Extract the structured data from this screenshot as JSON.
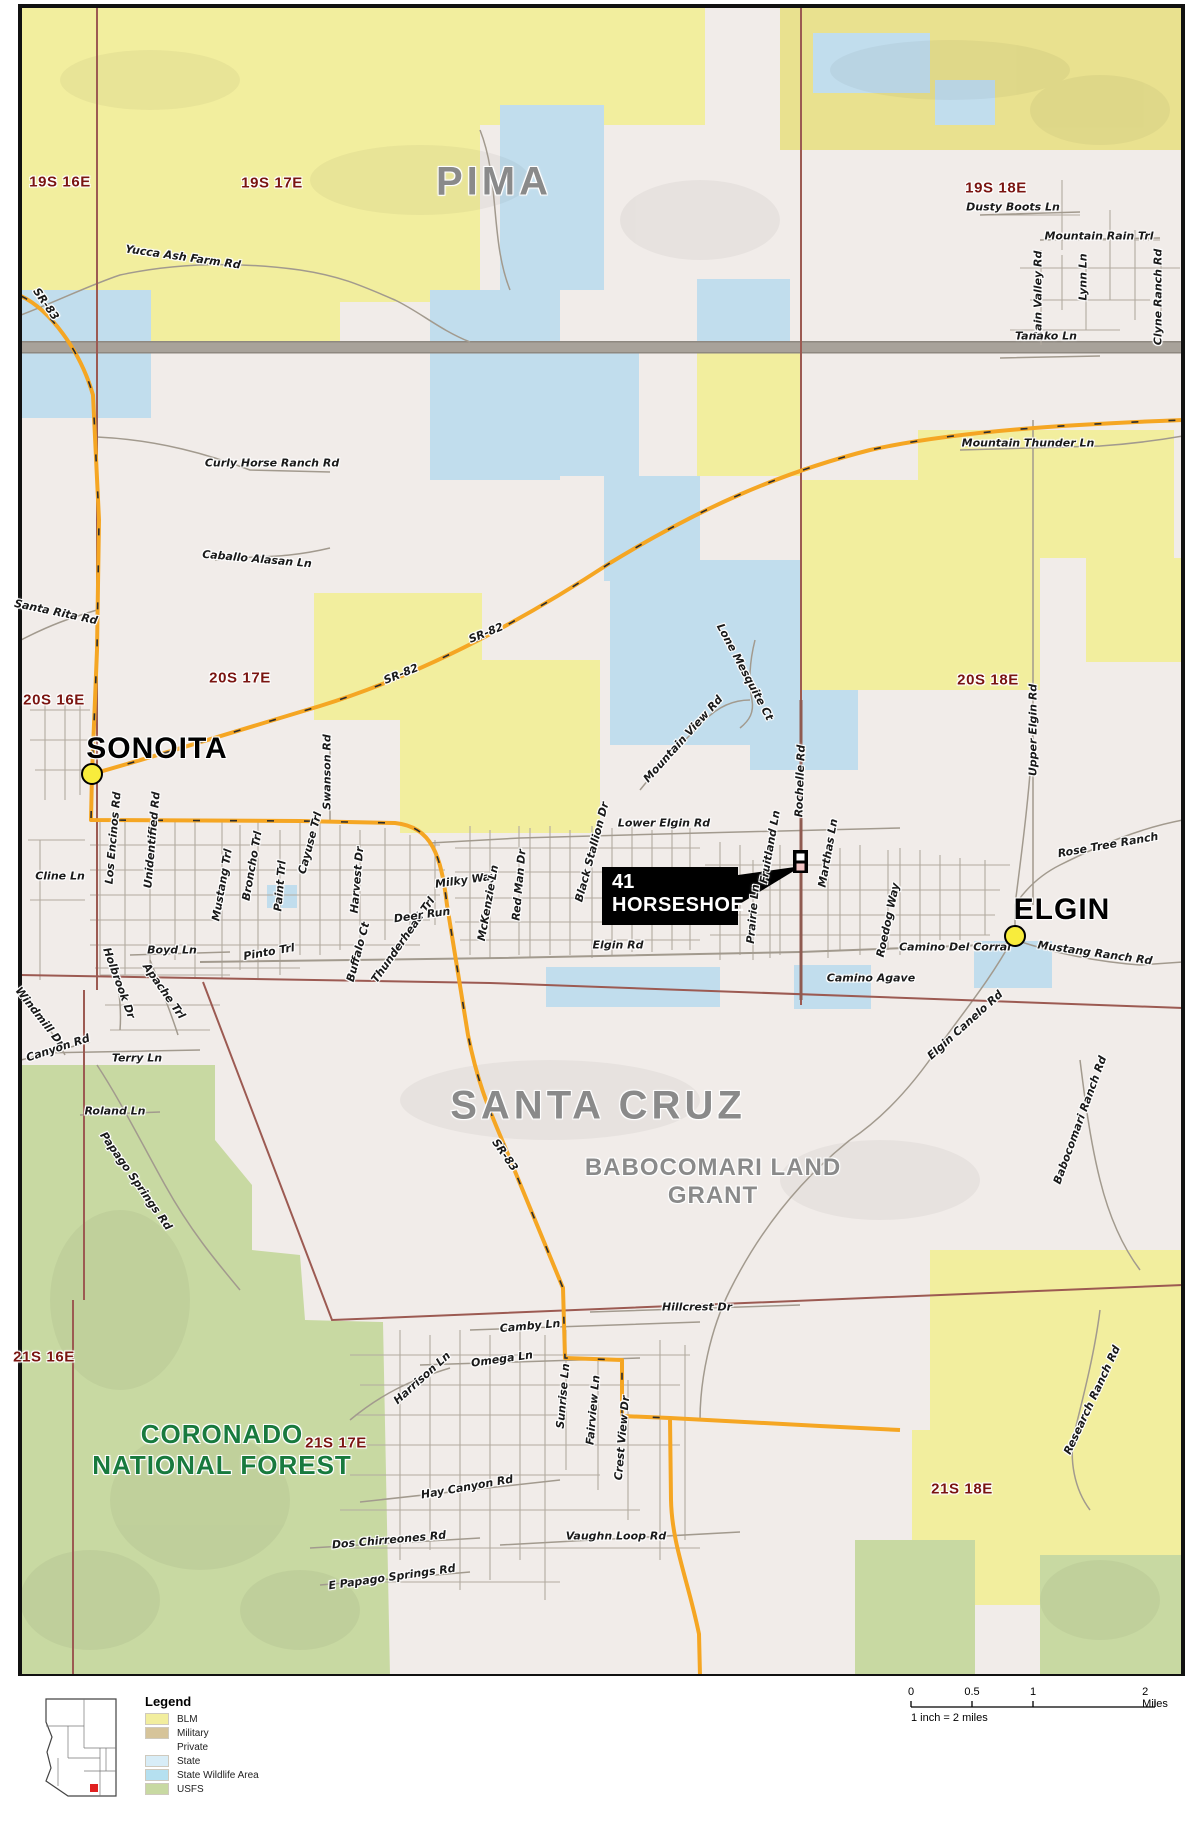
{
  "map": {
    "counties": [
      {
        "t": "PIMA",
        "x": 494,
        "y": 182
      },
      {
        "t": "SANTA CRUZ",
        "x": 598,
        "y": 1106
      }
    ],
    "towns": [
      {
        "t": "SONOITA",
        "x": 157,
        "y": 749,
        "dx": 92,
        "dy": 774
      },
      {
        "t": "ELGIN",
        "x": 1062,
        "y": 910,
        "dx": 1015,
        "dy": 936
      }
    ],
    "townships": [
      {
        "t": "19S 16E",
        "x": 60,
        "y": 182
      },
      {
        "t": "19S 17E",
        "x": 272,
        "y": 183
      },
      {
        "t": "19S 18E",
        "x": 996,
        "y": 188
      },
      {
        "t": "20S 16E",
        "x": 54,
        "y": 700
      },
      {
        "t": "20S 17E",
        "x": 240,
        "y": 678
      },
      {
        "t": "20S 18E",
        "x": 988,
        "y": 680
      },
      {
        "t": "21S 16E",
        "x": 44,
        "y": 1357
      },
      {
        "t": "21S 17E",
        "x": 336,
        "y": 1443
      },
      {
        "t": "21S 18E",
        "x": 962,
        "y": 1489
      }
    ],
    "areas": [
      {
        "cls": "area-green",
        "lines": [
          "CORONADO",
          "NATIONAL FOREST"
        ],
        "x": 222,
        "y": 1450
      },
      {
        "cls": "area-gray",
        "lines": [
          "BABOCOMARI LAND",
          "GRANT"
        ],
        "x": 713,
        "y": 1182
      }
    ],
    "callout": {
      "line1": "41",
      "line2": "HORSESHOE"
    },
    "roads": [
      {
        "t": "Yucca Ash Farm Rd",
        "x": 183,
        "y": 257,
        "r": 8
      },
      {
        "t": "SR-83",
        "x": 46,
        "y": 304,
        "r": 55
      },
      {
        "t": "Dusty Boots Ln",
        "x": 1013,
        "y": 207,
        "r": 0
      },
      {
        "t": "Mountain Rain Trl",
        "x": 1099,
        "y": 236,
        "r": 0
      },
      {
        "t": "Rain Valley Rd",
        "x": 1038,
        "y": 295,
        "r": -90
      },
      {
        "t": "Lynn Ln",
        "x": 1083,
        "y": 277,
        "r": -90
      },
      {
        "t": "Clyne Ranch Rd",
        "x": 1158,
        "y": 297,
        "r": -90
      },
      {
        "t": "Tanako Ln",
        "x": 1046,
        "y": 336,
        "r": 0
      },
      {
        "t": "Mountain Thunder Ln",
        "x": 1028,
        "y": 443,
        "r": 0
      },
      {
        "t": "Curly Horse Ranch Rd",
        "x": 272,
        "y": 463,
        "r": 0
      },
      {
        "t": "Caballo Alasan Ln",
        "x": 257,
        "y": 559,
        "r": 5
      },
      {
        "t": "Santa Rita Rd",
        "x": 56,
        "y": 612,
        "r": 12
      },
      {
        "t": "SR-82",
        "x": 401,
        "y": 674,
        "r": -22
      },
      {
        "t": "SR-82",
        "x": 486,
        "y": 633,
        "r": -22
      },
      {
        "t": "Lone Mesquite Ct",
        "x": 745,
        "y": 672,
        "r": 62
      },
      {
        "t": "Mountain View Rd",
        "x": 683,
        "y": 739,
        "r": -48
      },
      {
        "t": "Upper Elgin Rd",
        "x": 1033,
        "y": 730,
        "r": -90
      },
      {
        "t": "Swanson Rd",
        "x": 327,
        "y": 772,
        "r": -90
      },
      {
        "t": "Los Encinos Rd",
        "x": 113,
        "y": 838,
        "r": -85
      },
      {
        "t": "Unidentified Rd",
        "x": 152,
        "y": 840,
        "r": -85
      },
      {
        "t": "Cline Ln",
        "x": 60,
        "y": 876,
        "r": 0
      },
      {
        "t": "Mustang Trl",
        "x": 222,
        "y": 885,
        "r": -80
      },
      {
        "t": "Broncho Trl",
        "x": 252,
        "y": 866,
        "r": -80
      },
      {
        "t": "Paint Trl",
        "x": 280,
        "y": 886,
        "r": -85
      },
      {
        "t": "Cayuse Trl",
        "x": 310,
        "y": 843,
        "r": -75
      },
      {
        "t": "Harvest Dr",
        "x": 357,
        "y": 880,
        "r": -85
      },
      {
        "t": "Thunderhead Trl",
        "x": 403,
        "y": 940,
        "r": -55
      },
      {
        "t": "Deer Run",
        "x": 422,
        "y": 915,
        "r": -8
      },
      {
        "t": "Milky Way",
        "x": 466,
        "y": 880,
        "r": -8
      },
      {
        "t": "McKenzie Ln",
        "x": 488,
        "y": 903,
        "r": -80
      },
      {
        "t": "Red Man Dr",
        "x": 519,
        "y": 885,
        "r": -85
      },
      {
        "t": "Black Stallion Dr",
        "x": 592,
        "y": 852,
        "r": -75
      },
      {
        "t": "Lower Elgin Rd",
        "x": 664,
        "y": 823,
        "r": 0
      },
      {
        "t": "Fruitland Ln",
        "x": 770,
        "y": 847,
        "r": -80
      },
      {
        "t": "Rochelle Rd",
        "x": 800,
        "y": 781,
        "r": -88
      },
      {
        "t": "Marthas Ln",
        "x": 828,
        "y": 853,
        "r": -80
      },
      {
        "t": "Prairie Ln",
        "x": 753,
        "y": 914,
        "r": -85
      },
      {
        "t": "Elgin Rd",
        "x": 618,
        "y": 945,
        "r": 0
      },
      {
        "t": "Buffalo Ct",
        "x": 358,
        "y": 952,
        "r": -75
      },
      {
        "t": "Pinto Trl",
        "x": 269,
        "y": 952,
        "r": -10
      },
      {
        "t": "Boyd Ln",
        "x": 172,
        "y": 950,
        "r": 0
      },
      {
        "t": "Apache Trl",
        "x": 164,
        "y": 991,
        "r": 55
      },
      {
        "t": "Holbrook Dr",
        "x": 119,
        "y": 983,
        "r": 70
      },
      {
        "t": "Windmill Dr",
        "x": 40,
        "y": 1017,
        "r": 52
      },
      {
        "t": "Canyon Rd",
        "x": 58,
        "y": 1048,
        "r": -18
      },
      {
        "t": "Terry Ln",
        "x": 137,
        "y": 1058,
        "r": 0
      },
      {
        "t": "Roland Ln",
        "x": 115,
        "y": 1111,
        "r": 0
      },
      {
        "t": "Papago Springs Rd",
        "x": 136,
        "y": 1181,
        "r": 55
      },
      {
        "t": "Rose Tree Ranch",
        "x": 1108,
        "y": 845,
        "r": -10
      },
      {
        "t": "Camino Del Corral",
        "x": 955,
        "y": 947,
        "r": 0
      },
      {
        "t": "Mustang Ranch Rd",
        "x": 1095,
        "y": 953,
        "r": 8
      },
      {
        "t": "Camino Agave",
        "x": 871,
        "y": 978,
        "r": 0
      },
      {
        "t": "Roedog Way",
        "x": 888,
        "y": 920,
        "r": -78
      },
      {
        "t": "Elgin Canelo Rd",
        "x": 965,
        "y": 1025,
        "r": -42
      },
      {
        "t": "Babocomari Ranch Rd",
        "x": 1080,
        "y": 1120,
        "r": -70
      },
      {
        "t": "Research Ranch Rd",
        "x": 1092,
        "y": 1400,
        "r": -65
      },
      {
        "t": "SR-83",
        "x": 505,
        "y": 1155,
        "r": 55
      },
      {
        "t": "Hillcrest Dr",
        "x": 697,
        "y": 1307,
        "r": 0
      },
      {
        "t": "Camby Ln",
        "x": 530,
        "y": 1326,
        "r": -5
      },
      {
        "t": "Omega Ln",
        "x": 502,
        "y": 1359,
        "r": -8
      },
      {
        "t": "Harrison Ln",
        "x": 422,
        "y": 1378,
        "r": -42
      },
      {
        "t": "Sunrise Ln",
        "x": 563,
        "y": 1396,
        "r": -85
      },
      {
        "t": "Fairview Ln",
        "x": 593,
        "y": 1410,
        "r": -85
      },
      {
        "t": "Crest View Dr",
        "x": 622,
        "y": 1438,
        "r": -85
      },
      {
        "t": "Hay Canyon Rd",
        "x": 467,
        "y": 1487,
        "r": -10
      },
      {
        "t": "Dos Chirreones Rd",
        "x": 389,
        "y": 1540,
        "r": -5
      },
      {
        "t": "Vaughn Loop Rd",
        "x": 616,
        "y": 1536,
        "r": 0
      },
      {
        "t": "E Papago Springs Rd",
        "x": 392,
        "y": 1577,
        "r": -8
      }
    ]
  },
  "footer": {
    "legend": {
      "title": "Legend",
      "items": [
        {
          "label": "BLM",
          "color": "#f2ee9e"
        },
        {
          "label": "Military",
          "color": "#d6c49a"
        },
        {
          "label": "Private",
          "color": "#ffffff"
        },
        {
          "label": "State",
          "color": "#d8edf7"
        },
        {
          "label": "State Wildlife Area",
          "color": "#b5e0f0"
        },
        {
          "label": "USFS",
          "color": "#c8d9a2"
        }
      ]
    },
    "scalebar": {
      "ticks": [
        {
          "label": "0",
          "pos": 0
        },
        {
          "label": "0.5",
          "pos": 61
        },
        {
          "label": "1",
          "pos": 122
        },
        {
          "label": "2 Miles",
          "pos": 244
        }
      ],
      "note": "1 inch = 2 miles"
    },
    "inset_name": "arizona-locator-map"
  },
  "colors": {
    "blm": "#f2ee9e",
    "blm_shaded": "#e9e18f",
    "state_wildlife": "#c1dded",
    "usfs": "#c8d9a2",
    "private": "#f1ece9",
    "highway": "#f5a623",
    "township_line": "#9c5a52",
    "minor_road": "#b2aaa0",
    "county_label": "#8a8a8a",
    "township_label": "#7a1410",
    "forest_label": "#187a3e"
  }
}
